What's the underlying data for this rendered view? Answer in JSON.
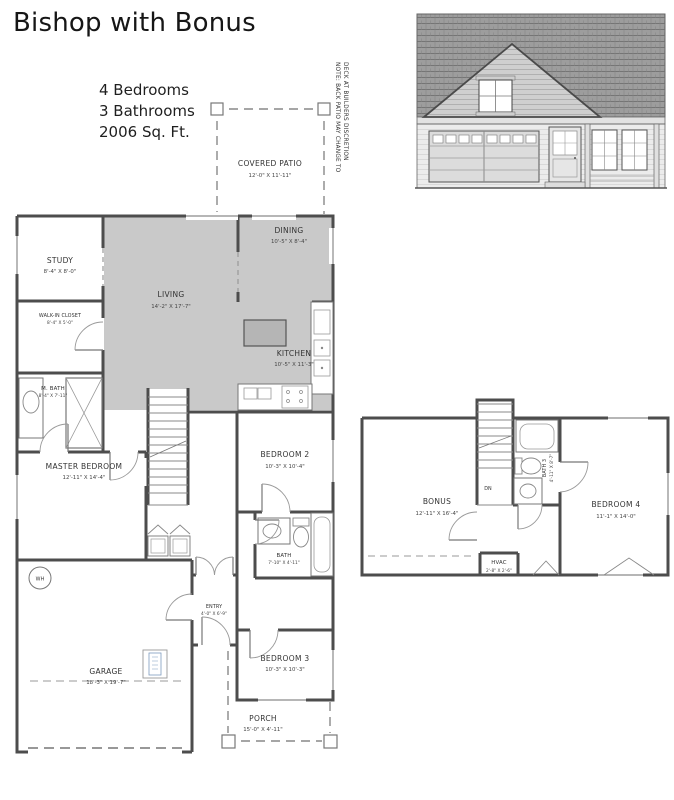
{
  "title": "Bishop with Bonus",
  "stats": {
    "line1": "4 Bedrooms",
    "line2": "3 Bathrooms",
    "line3": "2006 Sq. Ft."
  },
  "note": {
    "line1": "NOTE: BACK PATIO MAY CHANGE TO",
    "line2": "DECK AT BUILDERS DISCRETION"
  },
  "first_floor": {
    "covered_patio": {
      "label": "COVERED PATIO",
      "dim": "12'-0\" X 11'-11\""
    },
    "dining": {
      "label": "DINING",
      "dim": "10'-5\" X 8'-4\""
    },
    "study": {
      "label": "STUDY",
      "dim": "8'-4\" X 8'-0\""
    },
    "walk_in_closet": {
      "label": "WALK-IN CLOSET",
      "dim": "8'-4\" X 5'-0\""
    },
    "living": {
      "label": "LIVING",
      "dim": "14'-2\" X 17'-7\""
    },
    "kitchen": {
      "label": "KITCHEN",
      "dim": "10'-5\" X 11'-3\""
    },
    "m_bath": {
      "label": "M. BATH",
      "dim": "8'-4\" X 7'-11\""
    },
    "master_bedroom": {
      "label": "MASTER BEDROOM",
      "dim": "12'-11\" X 14'-4\""
    },
    "bedroom2": {
      "label": "BEDROOM 2",
      "dim": "10'-3\" X 10'-4\""
    },
    "bath": {
      "label": "BATH",
      "dim": "7'-10\" X 4'-11\""
    },
    "entry": {
      "label": "ENTRY",
      "dim": "4'-0\" X 6'-9\""
    },
    "bedroom3": {
      "label": "BEDROOM 3",
      "dim": "10'-3\" X 10'-3\""
    },
    "garage": {
      "label": "GARAGE",
      "dim": "18'-3\" X 19'-7\""
    },
    "porch": {
      "label": "PORCH",
      "dim": "15'-0\" X 4'-11\""
    },
    "water_heater": "WH"
  },
  "second_floor": {
    "bonus": {
      "label": "BONUS",
      "dim": "12'-11\" X 16'-4\""
    },
    "bath3": {
      "label": "BATH 3",
      "dim": "4'-11\" X 8'-7\""
    },
    "bedroom4": {
      "label": "BEDROOM 4",
      "dim": "11'-1\" X 14'-0\""
    },
    "hvac": {
      "label": "HVAC",
      "dim": "2'-8\" X 2'-6\""
    },
    "stairs_down": "DN"
  },
  "colors": {
    "wall": "#4d4d4d",
    "shade": "#c9c9c9",
    "accent_blue": "#7d9bbf"
  }
}
